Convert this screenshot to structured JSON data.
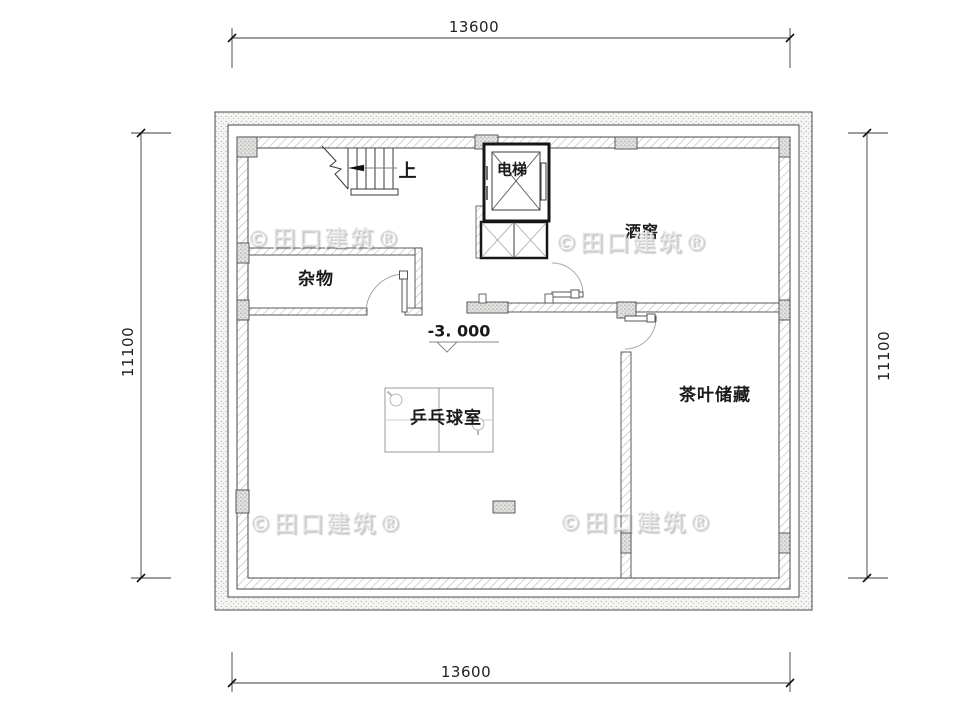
{
  "plan": {
    "watermark": "©田口建筑®",
    "dimensions": {
      "top": "13600",
      "bottom": "13600",
      "left": "11100",
      "right": "11100"
    },
    "labels": {
      "storage_room": "杂物",
      "elevator": "电梯",
      "wine_cellar": "酒窖",
      "table_tennis_room": "乒乓球室",
      "tea_storage": "茶叶储藏",
      "stairs_up": "上",
      "floor_elevation": "-3. 000"
    },
    "colors": {
      "line": "#3a3a3a",
      "heavy_wall": "#161616",
      "hatch": "#adadad",
      "door_arc": "#a8a8a8",
      "text": "#1a1a1a"
    }
  }
}
